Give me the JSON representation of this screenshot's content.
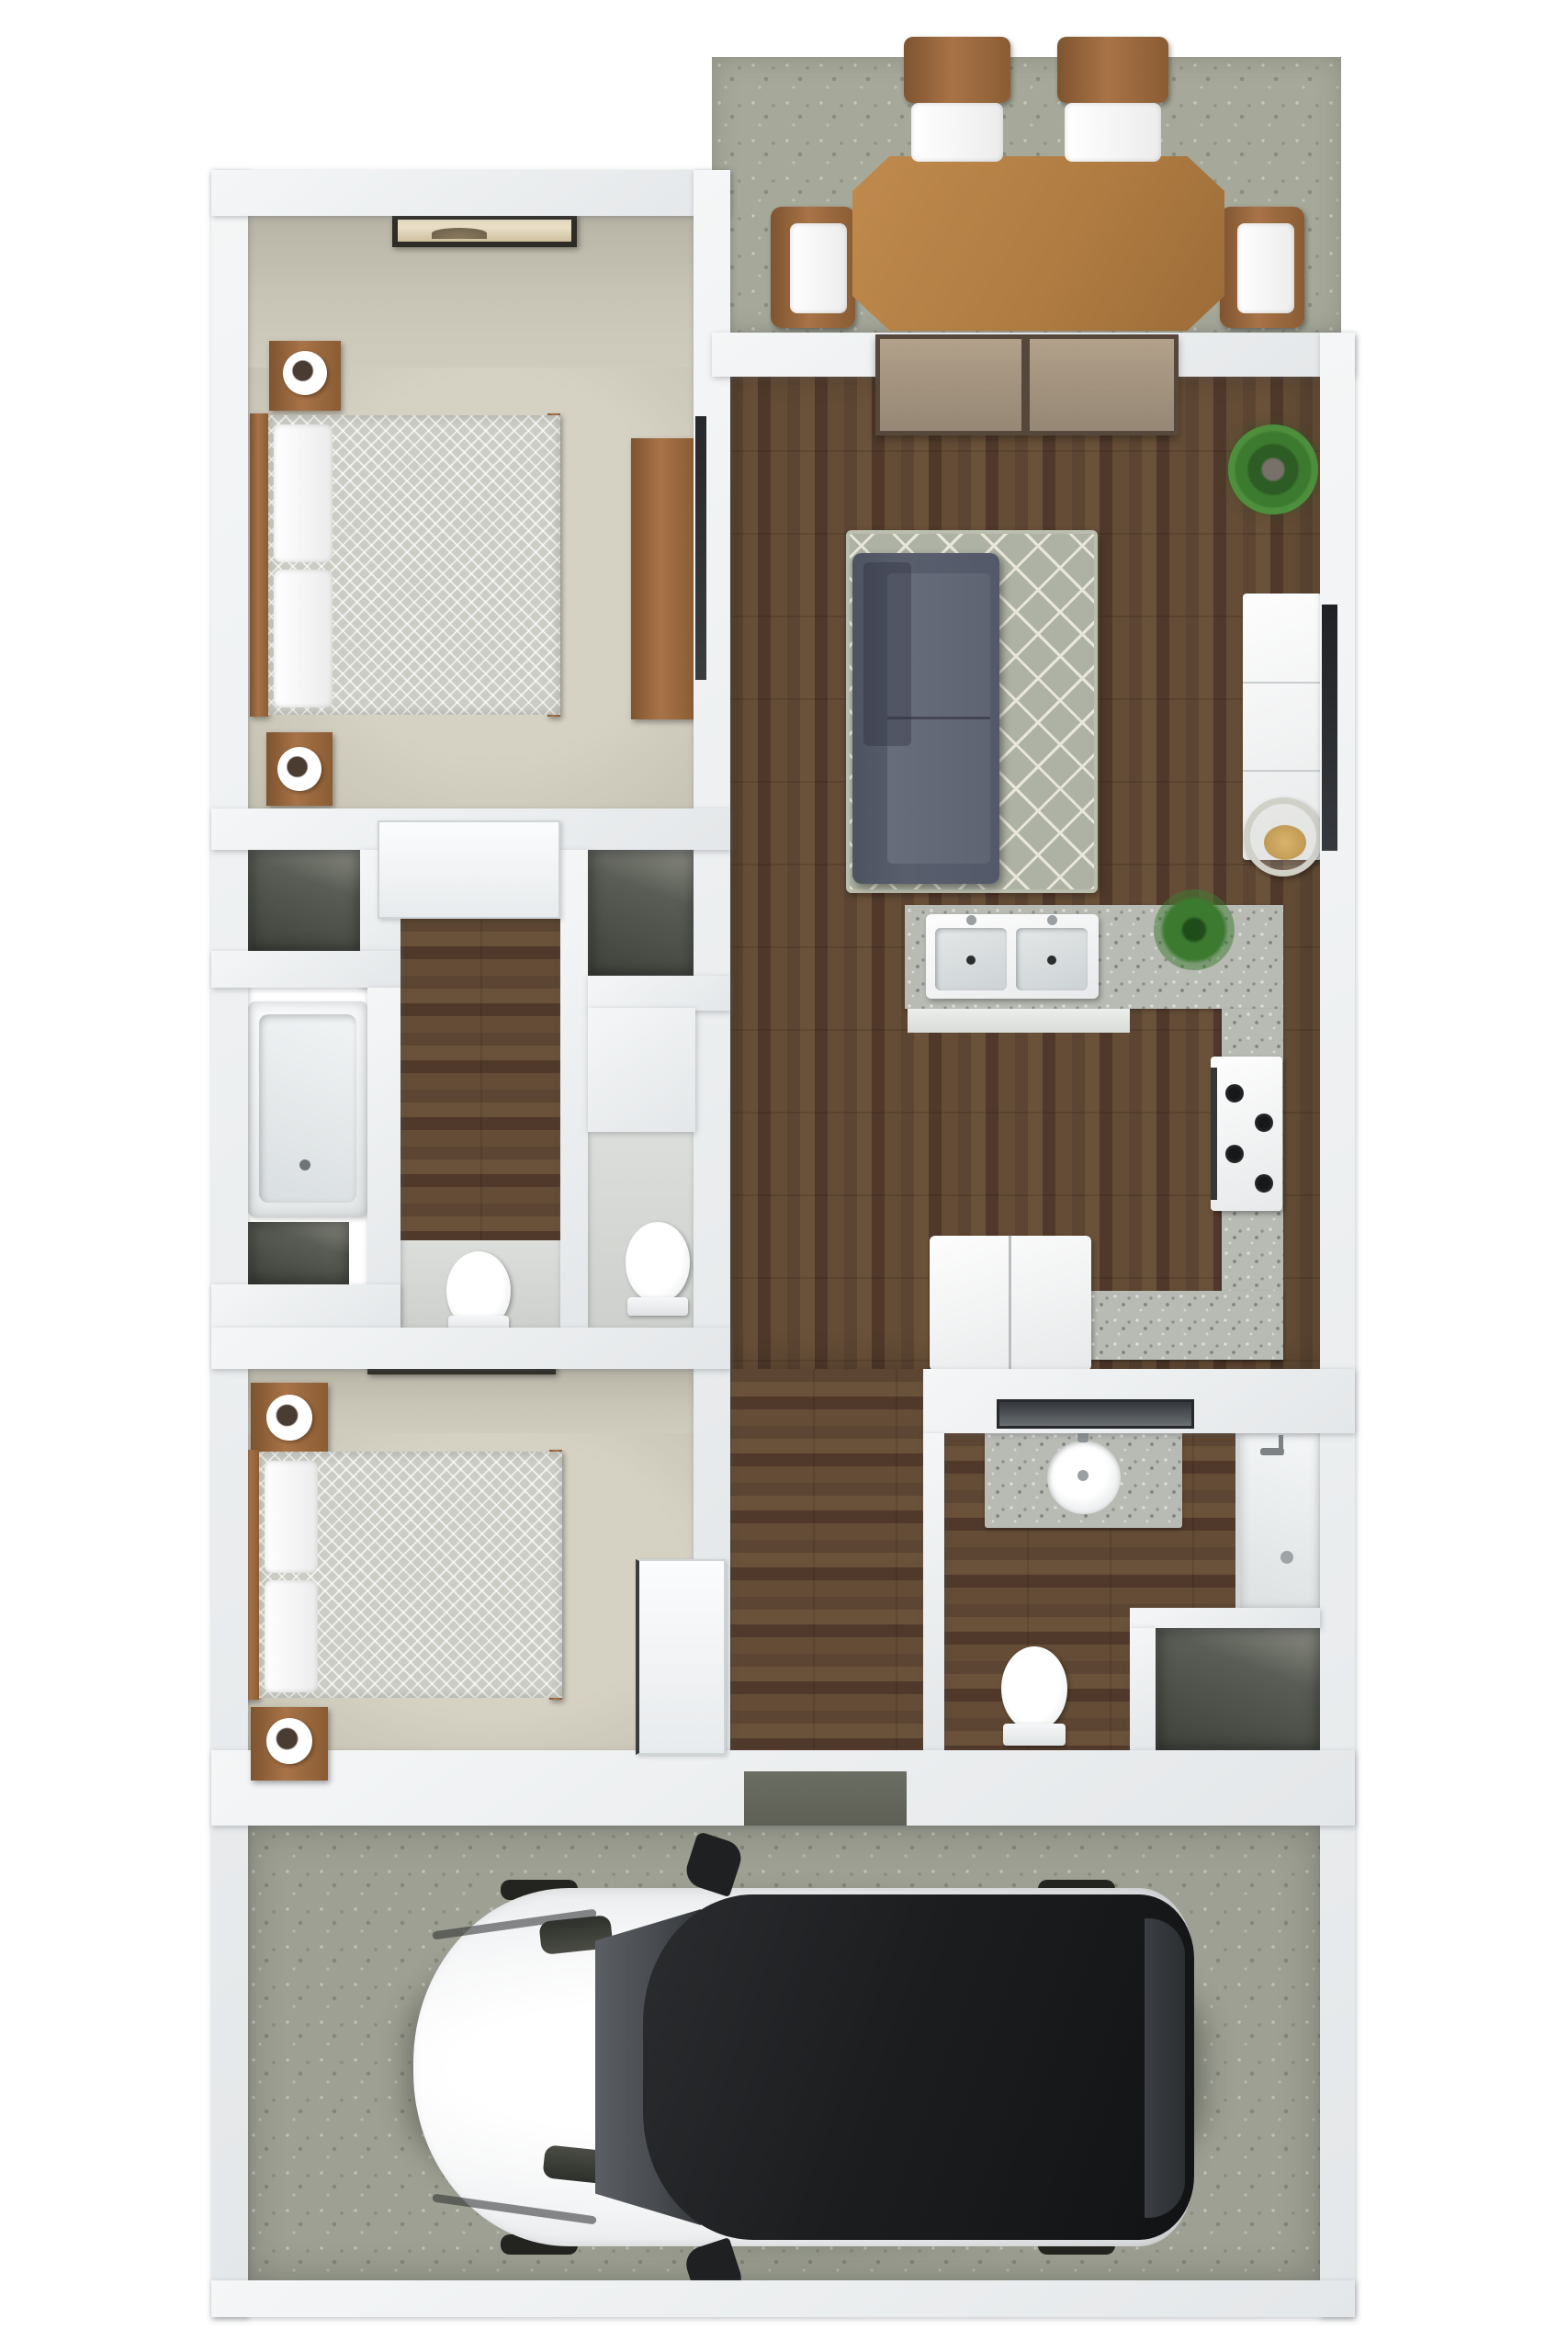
{
  "title": "3D floor plan — two-bedroom apartment with attached garage",
  "figure_type": "3d-floor-plan-top-view",
  "palette": {
    "wall": "#f4f6f7",
    "wall_shade": "#e4e7e9",
    "wall_face": "#c9c5b7",
    "carpet": "#d5d1c3",
    "concrete": "#a6a899",
    "concrete_garage": "#9da092",
    "granite": "#b8bbb4",
    "closet_dark": "#3f423b",
    "wood_floor_dark": "#50392a",
    "wood_floor_mid": "#6a5139",
    "furniture_wood": "#a87347",
    "furniture_wood_dark": "#7e5430",
    "sofa": "#595e6d",
    "sofa_seat": "#686d7c",
    "rug": "#adb2a4",
    "rug_line": "#e9e7d9",
    "plant_green": "#3c7a30",
    "cushion_tan": "#d9b36a",
    "mat_dark": "#5e6056",
    "car_body": "#f4f5f6",
    "car_roof": "#1b1d1f",
    "car_glass": "#474b4f",
    "mirror_dark": "#34373b"
  },
  "rooms": {
    "patio": {
      "label": "Patio with outdoor dining set",
      "furniture": [
        "dining-table",
        "patio-chair-north-left",
        "patio-chair-north-right",
        "patio-chair-west",
        "patio-chair-east"
      ]
    },
    "bedroom1": {
      "label": "Bedroom 1 (top left)",
      "furniture": [
        "wall-art",
        "bed",
        "pillows",
        "nightstand-top",
        "nightstand-bottom",
        "lamp",
        "dresser",
        "tv"
      ]
    },
    "living": {
      "label": "Living room",
      "furniture": [
        "sliding-glass-door",
        "area-rug",
        "sofa",
        "potted-plant",
        "tv-console",
        "tv",
        "round-chair"
      ]
    },
    "kitchen": {
      "label": "Kitchen",
      "furniture": [
        "double-sink",
        "counter-plant",
        "granite-counter",
        "range-stove",
        "refrigerator"
      ]
    },
    "hallway": {
      "label": "Hallway with closets",
      "furniture": [
        "hall-door",
        "closet-left",
        "closet-right",
        "linen-niche"
      ]
    },
    "bathroom1": {
      "label": "Hall bathroom",
      "furniture": [
        "bathtub",
        "vanity-strip",
        "toilet-a",
        "toilet-b"
      ]
    },
    "bedroom2": {
      "label": "Bedroom 2 (lower left)",
      "furniture": [
        "wall-art",
        "bed",
        "pillows",
        "nightstand-top",
        "nightstand-bottom",
        "lamp",
        "door"
      ]
    },
    "bathroom2": {
      "label": "En-suite bathroom (lower right)",
      "furniture": [
        "mirror",
        "granite-vanity",
        "round-sink",
        "toilet",
        "shower",
        "closet"
      ]
    },
    "garage": {
      "label": "Garage",
      "furniture": [
        "entry-mat",
        "car"
      ]
    }
  },
  "car": {
    "color": "white",
    "roof": "black",
    "orientation": "facing-left"
  },
  "visible_text": []
}
